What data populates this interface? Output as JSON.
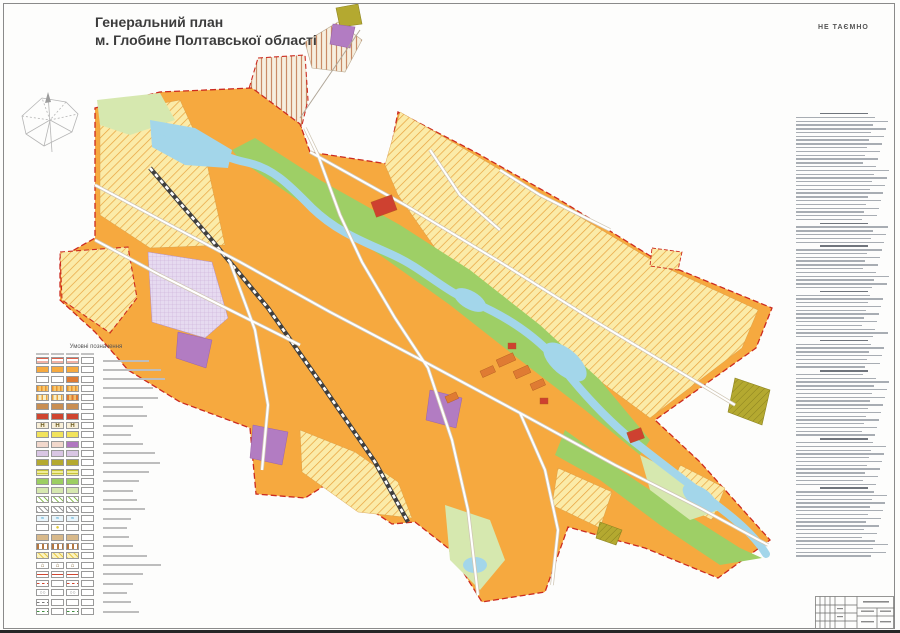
{
  "sheet": {
    "title_line1": "Генеральний план",
    "title_line2": "м. Глобине Полтавської області",
    "secrecy_stamp": "НЕ ТАЄМНО"
  },
  "legend": {
    "heading": "Умовні позначення",
    "column_count": 4,
    "rows": [
      {
        "c": [
          "rs",
          "rs",
          "rs",
          "e"
        ],
        "lw": 46
      },
      {
        "c": [
          "o",
          "o",
          "o",
          "e"
        ],
        "lw": 58
      },
      {
        "c": [
          "e",
          "e",
          "tx",
          "e"
        ],
        "lw": 62
      },
      {
        "c": [
          "ov",
          "ov",
          "ov",
          "e"
        ],
        "lw": 50
      },
      {
        "c": [
          "cs",
          "cs",
          "cs2",
          "e"
        ],
        "lw": 55
      },
      {
        "c": [
          "tan",
          "tan",
          "tan",
          "e"
        ],
        "lw": 40
      },
      {
        "c": [
          "red",
          "red",
          "red",
          "e"
        ],
        "lw": 44
      },
      {
        "c": [
          "H",
          "H",
          "H",
          "e"
        ],
        "lw": 30
      },
      {
        "c": [
          "y",
          "y",
          "y",
          "e"
        ],
        "lw": 28
      },
      {
        "c": [
          "pk",
          "pk",
          "pu",
          "e"
        ],
        "lw": 40
      },
      {
        "c": [
          "li",
          "li",
          "li",
          "e"
        ],
        "lw": 52
      },
      {
        "c": [
          "ol",
          "ol",
          "ol",
          "e"
        ],
        "lw": 57
      },
      {
        "c": [
          "yg",
          "yg",
          "yg",
          "e"
        ],
        "lw": 46
      },
      {
        "c": [
          "g",
          "g",
          "g",
          "e"
        ],
        "lw": 36
      },
      {
        "c": [
          "pg",
          "pg",
          "pg",
          "e"
        ],
        "lw": 30
      },
      {
        "c": [
          "gh",
          "gh",
          "gh",
          "e"
        ],
        "lw": 34
      },
      {
        "c": [
          "gy",
          "gy",
          "gy",
          "e"
        ],
        "lw": 42
      },
      {
        "c": [
          "w",
          "w",
          "w",
          "e"
        ],
        "lw": 28
      },
      {
        "c": [
          "e",
          "yc",
          "e",
          "e"
        ],
        "lw": 24
      },
      {
        "c": [
          "br",
          "br",
          "br",
          "e"
        ],
        "lw": 26
      },
      {
        "c": [
          "bs",
          "bs",
          "bs",
          "e"
        ],
        "lw": 30
      },
      {
        "c": [
          "yh",
          "yh",
          "yh",
          "e"
        ],
        "lw": 44
      },
      {
        "c": [
          "bld",
          "bld",
          "bld",
          "e"
        ],
        "lw": 58
      },
      {
        "c": [
          "lr",
          "lr",
          "lr",
          "e"
        ],
        "lw": 40
      },
      {
        "c": [
          "ld",
          "e",
          "ld",
          "e"
        ],
        "lw": 30
      },
      {
        "c": [
          "lco",
          "e",
          "lco",
          "e"
        ],
        "lw": 24
      },
      {
        "c": [
          "ld3",
          "e",
          "e",
          "e"
        ],
        "lw": 28
      },
      {
        "c": [
          "lgn",
          "e",
          "lgn",
          "e"
        ],
        "lw": 36
      }
    ],
    "glyphs": {
      "H": "Н",
      "w": "≈",
      "yc": "●",
      "bld": "⌂",
      "lco": "○○"
    }
  },
  "right_panel": {
    "line_count": 118,
    "heading_indices": [
      0,
      29,
      35,
      47,
      60,
      68,
      86,
      99
    ]
  },
  "map": {
    "palette": {
      "residential_orange": "#F6A93F",
      "multistorey_terracotta": "#DF7B33",
      "civic_red": "#CE4130",
      "field_yellow": "#FBEBA8",
      "field_stripe": "#E8A23C",
      "green": "#9ECF66",
      "pale_green": "#D6E8AF",
      "water": "#A3D6EA",
      "purple": "#B27CC2",
      "lilac": "#E6DAF0",
      "lilac_line": "#C9A8D4",
      "olive": "#B4A930",
      "cream": "#F6EFDF",
      "cream_stripe": "#C98B66",
      "road_fill": "#FFFFFF",
      "road_casing": "#CFC6B4",
      "railway_dark": "#3F3F3F",
      "boundary_red": "#CC2B20"
    }
  }
}
